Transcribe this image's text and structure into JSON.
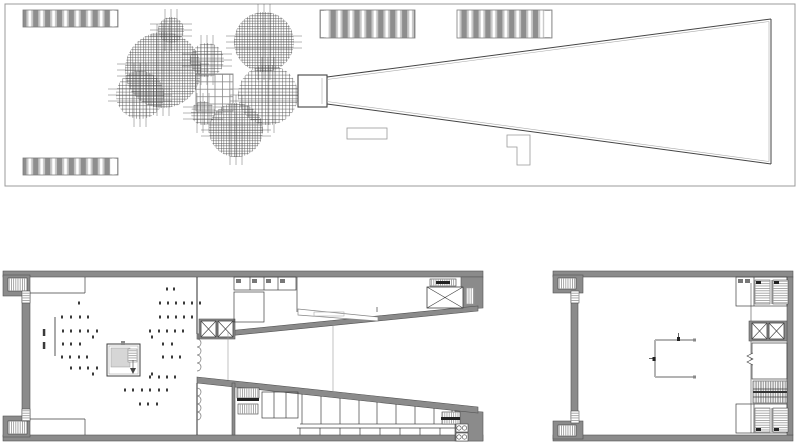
{
  "canvas": {
    "width": 800,
    "height": 447
  },
  "colors": {
    "background": "#ffffff",
    "wall_fill": "#8b8b8b",
    "wall_edge": "#545454",
    "dark_line": "#3f3f3f",
    "mid_line": "#666666",
    "light_line": "#aaaaaa",
    "pale_line": "#b3b3b3",
    "light_fill": "#d6d6d6",
    "stripe_bg": "#c9c9c9",
    "stripe_bar": "#8e8e8e",
    "hatch": "#4a4a4a",
    "dot": "#3a3a3a",
    "black": "#222222",
    "frame": "#9b9b9b"
  },
  "site_plan": {
    "frame": [
      5,
      4,
      790,
      182
    ],
    "striped_blocks": [
      {
        "box": [
          23,
          10,
          95,
          17
        ],
        "cap": "right"
      },
      {
        "box": [
          320,
          10,
          95,
          28
        ],
        "cap": "left"
      },
      {
        "box": [
          457,
          10,
          95,
          28
        ],
        "cap": "right"
      },
      {
        "box": [
          23,
          158,
          95,
          17
        ],
        "cap": "right"
      }
    ],
    "tree_clusters": [
      {
        "cx": 163,
        "cy": 70,
        "r": 38,
        "d": "fine"
      },
      {
        "cx": 171,
        "cy": 30,
        "r": 13,
        "d": "fine"
      },
      {
        "cx": 207,
        "cy": 60,
        "r": 17,
        "d": "coarse"
      },
      {
        "cx": 140,
        "cy": 95,
        "r": 24,
        "d": "coarse"
      },
      {
        "cx": 264,
        "cy": 42,
        "r": 30,
        "d": "fine"
      },
      {
        "cx": 268,
        "cy": 95,
        "r": 30,
        "d": "coarse"
      },
      {
        "cx": 236,
        "cy": 130,
        "r": 27,
        "d": "fine"
      },
      {
        "cx": 203,
        "cy": 113,
        "r": 12,
        "d": "coarse"
      }
    ],
    "grid_square": {
      "box": [
        196,
        74,
        37,
        37
      ],
      "cell": 7.4
    },
    "wedge": {
      "neck": [
        298,
        75,
        29,
        32
      ],
      "top": [
        327,
        77,
        771,
        19
      ],
      "bottom": [
        327,
        104,
        771,
        164
      ],
      "right_x": 771
    },
    "small_rect": [
      347,
      128,
      40,
      11
    ],
    "l_shape": [
      [
        507,
        135
      ],
      [
        530,
        135
      ],
      [
        530,
        165
      ],
      [
        517,
        165
      ],
      [
        517,
        147
      ],
      [
        507,
        147
      ]
    ]
  },
  "main_plan": {
    "top_wall": [
      3,
      271,
      480,
      6
    ],
    "bottom_wall": [
      3,
      435,
      480,
      6
    ],
    "left_wall": [
      22,
      296,
      8,
      120
    ],
    "pockets": [
      {
        "block": [
          3,
          275,
          27,
          21
        ],
        "stair": [
          8,
          278,
          19,
          13
        ],
        "boxes": [
          22,
          291,
          8,
          12
        ]
      },
      {
        "block": [
          3,
          416,
          27,
          21
        ],
        "stair": [
          8,
          421,
          19,
          13
        ],
        "boxes": [
          22,
          409,
          8,
          12
        ]
      }
    ],
    "entry_rooms": [
      {
        "h": [
          30,
          293,
          85,
          293
        ],
        "v": [
          85,
          277,
          85,
          293
        ]
      },
      {
        "h": [
          30,
          419,
          85,
          419
        ],
        "v": [
          85,
          419,
          85,
          435
        ]
      }
    ],
    "screen_wall": [
      55,
      317,
      55,
      356
    ],
    "kiosk": {
      "outer": [
        107,
        344,
        33,
        32
      ],
      "inner_offset": 2,
      "gray_sq": [
        111,
        348,
        19,
        19
      ],
      "stair": [
        128,
        349,
        9,
        13
      ],
      "tick": [
        121,
        341,
        4,
        4
      ],
      "arrow_stem": [
        133,
        360,
        133,
        368
      ],
      "arrow": [
        [
          130,
          368
        ],
        [
          136,
          368
        ],
        [
          133,
          374
        ]
      ]
    },
    "dot_rows": [
      {
        "y": 289,
        "xs": [
          167,
          174
        ]
      },
      {
        "y": 303,
        "xs": [
          79,
          160,
          168,
          176,
          184,
          192,
          200
        ]
      },
      {
        "y": 317,
        "xs": [
          62,
          71,
          80,
          88,
          160,
          168,
          176,
          184,
          192
        ]
      },
      {
        "y": 331,
        "xs": [
          63,
          71,
          80,
          88,
          97,
          150,
          159,
          167,
          175,
          183
        ]
      },
      {
        "y": 344,
        "xs": [
          63,
          71,
          80,
          163,
          172
        ]
      },
      {
        "y": 357,
        "xs": [
          62,
          70,
          79,
          87,
          163,
          172,
          180
        ]
      },
      {
        "y": 368,
        "xs": [
          71,
          80,
          88,
          97
        ]
      },
      {
        "y": 377,
        "xs": [
          150,
          159,
          167,
          175
        ]
      },
      {
        "y": 390,
        "xs": [
          125,
          133,
          142,
          150,
          159,
          167
        ]
      },
      {
        "y": 404,
        "xs": [
          140,
          148,
          157
        ]
      },
      {
        "y": 337,
        "xs": [
          93,
          152
        ]
      },
      {
        "y": 374,
        "xs": [
          93,
          152
        ]
      }
    ],
    "dashes": [
      [
        44,
        329
      ],
      [
        44,
        342
      ]
    ],
    "mid_wall": {
      "x": 197,
      "seg_a": [
        277,
        334
      ],
      "curtain_a": [
        339,
        377
      ],
      "seg_b": [
        383,
        435
      ],
      "curtain_b": [
        388,
        420
      ],
      "scallop_r": 4
    },
    "elevator_bank": {
      "surround": [
        199,
        319,
        36,
        20
      ],
      "cars": [
        [
          201,
          321,
          15,
          16
        ],
        [
          218,
          321,
          15,
          16
        ]
      ]
    },
    "toilet_row": {
      "outline": [
        234,
        277,
        62,
        13
      ],
      "verticals": [
        250,
        264,
        278
      ],
      "fixtures": [
        [
          236,
          279,
          5,
          4
        ],
        [
          252,
          279,
          5,
          4
        ],
        [
          266,
          279,
          5,
          4
        ],
        [
          280,
          279,
          5,
          4
        ]
      ]
    },
    "room_nw": {
      "outline": [
        234,
        292,
        30,
        30
      ]
    },
    "partition_v": [
      297,
      277,
      297,
      312
    ],
    "ramp": {
      "poly": [
        [
          298,
          309
        ],
        [
          378,
          317
        ],
        [
          378,
          321
        ],
        [
          298,
          315
        ]
      ],
      "inner": [
        314,
        312,
        30,
        4
      ],
      "tick": [
        377,
        307,
        377,
        312
      ]
    },
    "freight": {
      "stair": [
        430,
        279,
        26,
        7
      ],
      "bar": [
        436,
        281,
        14,
        3
      ],
      "car": [
        427,
        287,
        36,
        21
      ],
      "hatch": [
        466,
        288,
        8,
        16
      ]
    },
    "band_top": {
      "x0": 197,
      "y0": 334,
      "x1": 478,
      "y1": 306,
      "th": 5
    },
    "band_bottom": {
      "x0": 197,
      "y0": 377,
      "x1": 478,
      "y1": 407,
      "th": 6
    },
    "corner_tr": [
      [
        461,
        277
      ],
      [
        483,
        277
      ],
      [
        483,
        308
      ],
      [
        461,
        309
      ]
    ],
    "corner_br": [
      [
        455,
        410
      ],
      [
        483,
        412
      ],
      [
        483,
        441
      ],
      [
        455,
        441
      ]
    ],
    "section_lines": [
      [
        228,
        332,
        228,
        380
      ],
      [
        333,
        326,
        333,
        391
      ]
    ],
    "sw_cluster": {
      "wall": [
        232,
        383,
        3,
        52
      ],
      "stairs": [
        [
          237,
          388,
          22,
          10
        ],
        [
          238,
          404,
          20,
          10
        ]
      ],
      "bar": [
        237,
        398,
        22,
        3
      ],
      "room": [
        262,
        392,
        36,
        26
      ],
      "verticals": [
        274,
        286
      ]
    },
    "corridor": [
      300,
      424,
      458,
      424
    ],
    "rooms_upper": {
      "xs": [
        302,
        321,
        340,
        359,
        377,
        396,
        415,
        434,
        452
      ],
      "bottom_y": 424
    },
    "rooms_lower": {
      "xs": [
        300,
        320,
        340,
        360,
        380,
        400,
        420,
        440
      ],
      "top_y": 428,
      "bottom_y": 435,
      "rail": [
        297,
        428,
        455,
        428
      ]
    },
    "service_stair": {
      "box": [
        442,
        412,
        18,
        12
      ],
      "bar": [
        441,
        417,
        19,
        3
      ]
    },
    "washers": [
      [
        456,
        424,
        12,
        8
      ],
      [
        456,
        433,
        12,
        8
      ]
    ]
  },
  "annex_plan": {
    "top_wall": [
      553,
      271,
      240,
      6
    ],
    "bottom_wall": [
      553,
      435,
      240,
      6
    ],
    "right_wall": [
      787,
      277,
      6,
      158
    ],
    "left_wall": [
      571,
      293,
      7,
      126
    ],
    "pockets": [
      {
        "block": [
          553,
          275,
          30,
          18
        ],
        "stair": [
          558,
          278,
          18,
          11
        ],
        "boxes": [
          571,
          291,
          8,
          12
        ]
      },
      {
        "block": [
          553,
          421,
          30,
          18
        ],
        "stair": [
          558,
          425,
          18,
          11
        ],
        "boxes": [
          571,
          411,
          8,
          12
        ]
      }
    ],
    "core_wall": [
      751,
      283,
      751,
      433
    ],
    "stair_room_top": {
      "outline": [
        736,
        277,
        51,
        29
      ],
      "flights": [
        [
          755,
          280,
          15,
          24
        ],
        [
          773,
          280,
          15,
          24
        ]
      ],
      "divider": [
        772,
        280,
        772,
        304
      ],
      "marks": [
        [
          756,
          281,
          5,
          3
        ],
        [
          774,
          281,
          5,
          3
        ]
      ],
      "sub_v": [
        754,
        277,
        754,
        306
      ],
      "fixtures": [
        [
          738,
          279,
          5,
          4
        ],
        [
          745,
          279,
          5,
          4
        ]
      ]
    },
    "elevator_bank": {
      "surround": [
        749,
        321,
        38,
        20
      ],
      "cars": [
        [
          752,
          323,
          15,
          16
        ],
        [
          769,
          323,
          15,
          16
        ]
      ]
    },
    "room": {
      "outline": [
        752,
        343,
        35,
        36
      ],
      "door_zigzag": [
        [
          753,
          353
        ],
        [
          747,
          356
        ],
        [
          753,
          359
        ],
        [
          747,
          362
        ],
        [
          753,
          365
        ]
      ]
    },
    "escalator": {
      "box": [
        753,
        381,
        34,
        22
      ],
      "band": [
        753,
        391,
        34,
        2
      ],
      "lines": [
        389,
        397
      ]
    },
    "stair_room_bottom": {
      "outline": [
        736,
        404,
        51,
        29
      ],
      "flights": [
        [
          755,
          408,
          15,
          24
        ],
        [
          773,
          408,
          15,
          24
        ]
      ],
      "divider": [
        772,
        408,
        772,
        432
      ],
      "marks": [
        [
          756,
          428,
          5,
          3
        ],
        [
          774,
          428,
          5,
          3
        ]
      ],
      "sub_v": [
        754,
        404,
        754,
        433
      ]
    },
    "c_element": {
      "v": [
        655,
        340,
        655,
        377
      ],
      "top": [
        655,
        340,
        695,
        340
      ],
      "bottom": [
        655,
        377,
        695,
        377
      ],
      "caps": [
        [
          693,
          338.5,
          3,
          3
        ],
        [
          693,
          375.5,
          3,
          3
        ]
      ],
      "marks": [
        {
          "dot": [
            677,
            337,
            3,
            4
          ],
          "stem": [
            678.5,
            333,
            678.5,
            337
          ]
        },
        {
          "dot": [
            652.5,
            357,
            3,
            4
          ],
          "stem": [
            649,
            358.5,
            652.5,
            358.5
          ]
        }
      ]
    }
  }
}
